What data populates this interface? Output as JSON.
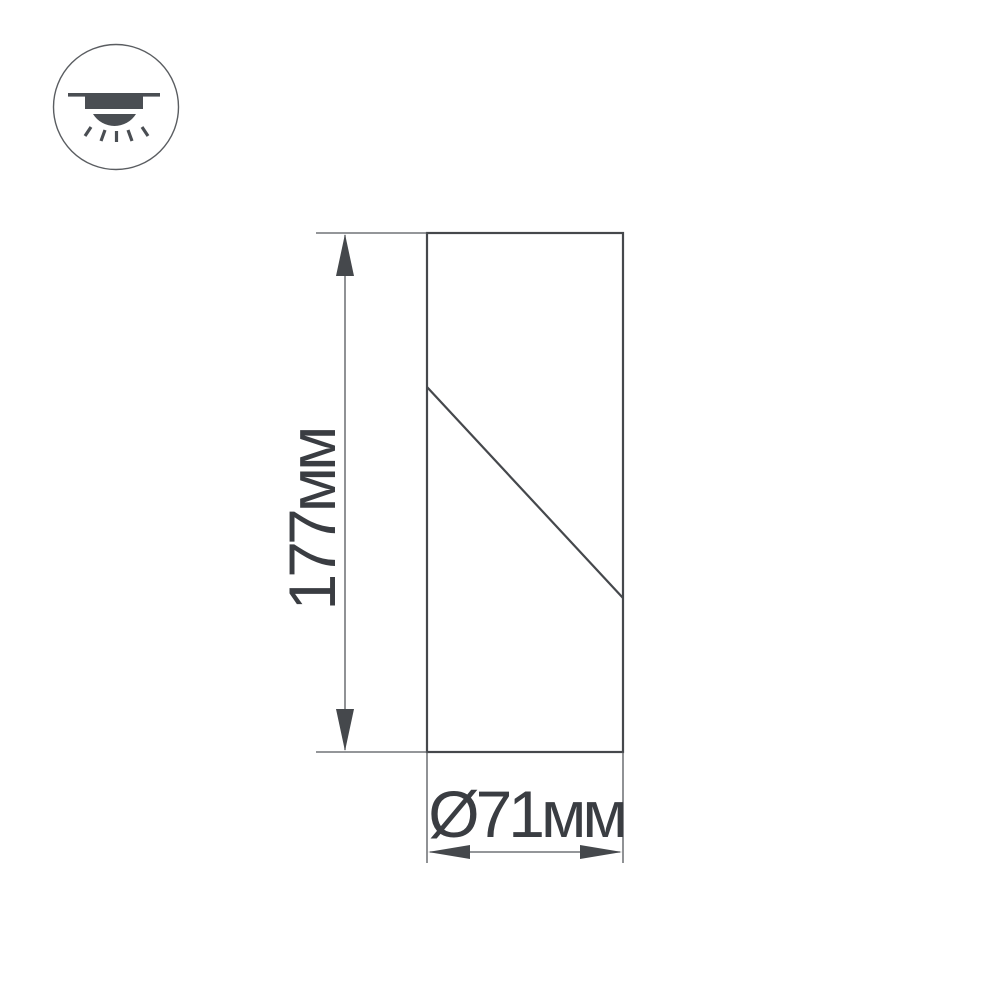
{
  "diagram": {
    "type": "product-dimension-drawing",
    "height_label": "177мм",
    "diameter_label": "Ø71мм",
    "height_mm": 177,
    "diameter_mm": 71
  },
  "icon": {
    "name": "ceiling-surface-mounted-light",
    "fill_color": "#4a4e53",
    "circle_color": "#5a5d61"
  },
  "colors": {
    "outline": "#45484c",
    "dimension_lines": "#55585c",
    "arrowheads": "#45484c",
    "text": "#3a3d42",
    "background": "#ffffff"
  }
}
